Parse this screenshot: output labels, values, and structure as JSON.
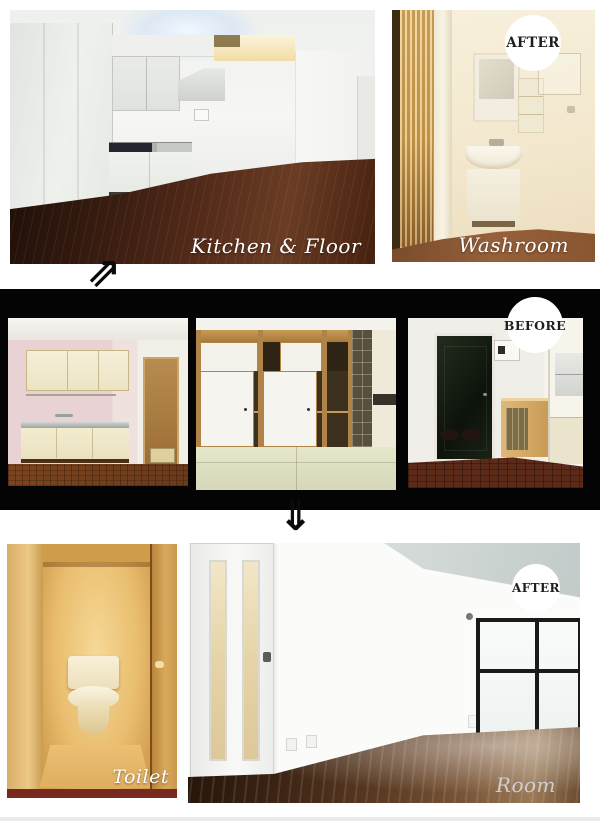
{
  "colors": {
    "page_background": "#ffffff",
    "strip_background": "#040404",
    "badge_background": "#ffffff",
    "badge_text": "#1f1f1f",
    "caption_text": "#ffffff",
    "room_caption_text": "#d6d9df",
    "arrow": "#0a0a0a"
  },
  "top_row": {
    "kitchen_photo": {
      "caption": "Kitchen & Floor"
    },
    "washroom_photo": {
      "caption": "Washroom",
      "badge": "AFTER"
    }
  },
  "transition": {
    "up_arrow_glyph": "⇗",
    "down_arrow_glyph": "⇓"
  },
  "before_strip": {
    "badge": "BEFORE"
  },
  "bottom_row": {
    "toilet_photo": {
      "caption": "Toilet"
    },
    "room_photo": {
      "caption": "Room",
      "badge": "AFTER"
    }
  }
}
